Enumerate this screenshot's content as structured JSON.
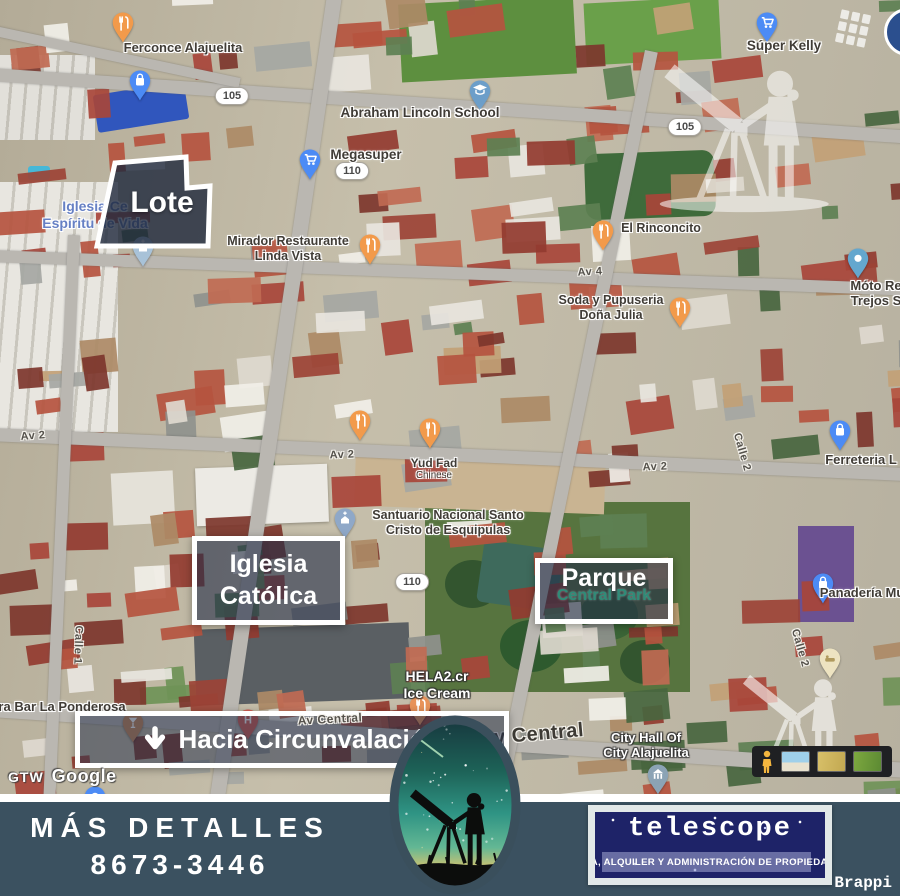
{
  "colors": {
    "footer_bg": "#3b5160",
    "overlay_navy": "#212c46",
    "brand_navy": "#1e2368",
    "pin_orange": "#F29A4B",
    "pin_blue": "#4C8BF5",
    "park_label_teal": "#2f8c78",
    "place_label_blue": "#6680c4"
  },
  "map": {
    "overlays": {
      "lote_label": "Lote",
      "iglesia_line1": "Iglesia",
      "iglesia_line2": "Católica",
      "parque_title": "Parque",
      "parque_subtitle": "Central Park",
      "banner_text": "Hacia Circunvalación"
    },
    "route_badges": [
      {
        "text": "105",
        "x": 232,
        "y": 96
      },
      {
        "text": "105",
        "x": 685,
        "y": 127
      },
      {
        "text": "110",
        "x": 352,
        "y": 171
      },
      {
        "text": "110",
        "x": 412,
        "y": 582
      }
    ],
    "street_labels": [
      {
        "text": "Av 4",
        "x": 590,
        "y": 272,
        "rot": -3,
        "size": 11
      },
      {
        "text": "Av 2",
        "x": 33,
        "y": 436,
        "rot": -4,
        "size": 11
      },
      {
        "text": "Av 2",
        "x": 342,
        "y": 455,
        "rot": -2,
        "size": 11
      },
      {
        "text": "Av 2",
        "x": 655,
        "y": 467,
        "rot": -2,
        "size": 11
      },
      {
        "text": "Av Central",
        "x": 330,
        "y": 719,
        "rot": -3,
        "size": 12,
        "z": 9
      },
      {
        "text": "Av Central",
        "x": 532,
        "y": 735,
        "rot": -5,
        "size": 20
      },
      {
        "text": "Calle 1",
        "x": 78,
        "y": 645,
        "rot": 92,
        "size": 11
      },
      {
        "text": "Calle 2",
        "x": 742,
        "y": 452,
        "rot": 74,
        "size": 11
      },
      {
        "text": "Calle 2",
        "x": 800,
        "y": 648,
        "rot": 74,
        "size": 11
      }
    ],
    "pois": [
      {
        "pin": "restaurant",
        "color": "#F29A4B",
        "px": 123,
        "py": 16
      },
      {
        "pin": "bag",
        "color": "#4C8BF5",
        "px": 140,
        "py": 74,
        "lines": [
          "Ferconce Alajuelita"
        ],
        "lx": 183,
        "ly": 40,
        "style": "dark",
        "size": 13
      },
      {
        "pin": "school",
        "color": "#6C9EC9",
        "px": 480,
        "py": 84,
        "lines": [
          "Abraham Lincoln School"
        ],
        "lx": 420,
        "ly": 105,
        "style": "dark",
        "size": 13.5
      },
      {
        "pin": "cart",
        "color": "#4C8BF5",
        "px": 310,
        "py": 153,
        "lines": [
          "Megasuper"
        ],
        "lx": 366,
        "ly": 147,
        "style": "dark",
        "size": 13.5
      },
      {
        "pin": "cart",
        "color": "#4C8BF5",
        "px": 767,
        "py": 16,
        "lines": [
          "Súper Kelly"
        ],
        "lx": 784,
        "ly": 38,
        "style": "dark",
        "size": 13.5
      },
      {
        "pin": "restaurant",
        "color": "#F29A4B",
        "px": 370,
        "py": 238,
        "lines": [
          "Mirador Restaurante",
          "Linda Vista"
        ],
        "lx": 288,
        "ly": 234,
        "style": "dark",
        "size": 12.5
      },
      {
        "pin": "restaurant",
        "color": "#F29A4B",
        "px": 603,
        "py": 224,
        "lines": [
          "El Rinconcito"
        ],
        "lx": 661,
        "ly": 221,
        "style": "dark",
        "size": 12.5
      },
      {
        "pin": "dot",
        "color": "#64A7CE",
        "px": 858,
        "py": 252,
        "lines": [
          "Móto Re",
          "Trejos S"
        ],
        "lx": 876,
        "ly": 278,
        "style": "dark",
        "size": 13
      },
      {
        "pin": "restaurant",
        "color": "#F29A4B",
        "px": 680,
        "py": 301,
        "lines": [
          "Soda y Pupuseria",
          "Doña Julia"
        ],
        "lx": 611,
        "ly": 293,
        "style": "dark",
        "size": 12.5
      },
      {
        "pin": "restaurant",
        "color": "#F29A4B",
        "px": 360,
        "py": 414
      },
      {
        "pin": "restaurant",
        "color": "#F29A4B",
        "px": 430,
        "py": 422,
        "lines": [
          "Yud Fad",
          "Chinese"
        ],
        "lx": 434,
        "ly": 456,
        "style": "dark",
        "size": 12,
        "sub": true
      },
      {
        "pin": "bag",
        "color": "#4C8BF5",
        "px": 840,
        "py": 424,
        "lines": [
          "Ferreteria L"
        ],
        "lx": 861,
        "ly": 452,
        "style": "dark",
        "size": 13
      },
      {
        "pin": "church",
        "color": "#8FA8C8",
        "px": 345,
        "py": 512,
        "lines": [
          "Santuario Nacional Santo",
          "Cristo de Esquipulas"
        ],
        "lx": 448,
        "ly": 508,
        "style": "dark",
        "size": 12.5
      },
      {
        "pin": "bag",
        "color": "#4C8BF5",
        "px": 823,
        "py": 577,
        "lines": [
          "Panadería Mu"
        ],
        "lx": 862,
        "ly": 585,
        "style": "dark",
        "size": 13
      },
      {
        "pin": "lodging",
        "color": "#EDE3C1",
        "px": 830,
        "py": 652
      },
      {
        "pin": "cocktail",
        "color": "#C98A5B",
        "px": 133,
        "py": 716
      },
      {
        "pin": "hospital",
        "color": "#D65F54",
        "px": 248,
        "py": 713
      },
      {
        "pin": "restaurant",
        "color": "#E8935A",
        "px": 420,
        "py": 699
      },
      {
        "pin": "church",
        "color": "#A8C2D8",
        "px": 143,
        "py": 240
      },
      {
        "pin": "bank",
        "color": "#8BA3B5",
        "px": 658,
        "py": 768,
        "lines": [
          "City Hall Of",
          "City Alajuelita"
        ],
        "lx": 646,
        "ly": 730,
        "style": "white",
        "size": 13
      },
      {
        "pin": "dot",
        "color": "#4C8BF5",
        "px": 95,
        "py": 790
      },
      {
        "lines": [
          "Iglesia Ce",
          "Espíritu de Vida"
        ],
        "lx": 95,
        "ly": 198,
        "style": "blue",
        "size": 14
      },
      {
        "lines": [
          "HELA2.cr",
          "Ice Cream"
        ],
        "lx": 437,
        "ly": 668,
        "style": "white",
        "size": 14
      },
      {
        "lines": [
          "Almacén"
        ],
        "lx": 852,
        "ly": 746,
        "style": "white",
        "size": 12.5
      },
      {
        "lines": [
          "ra Bar La Ponderosa"
        ],
        "lx": 62,
        "ly": 699,
        "style": "dark",
        "size": 13
      }
    ],
    "attribution": {
      "gtw": "GTW",
      "brand": "Google"
    }
  },
  "footer": {
    "details_label": "MÁS DETALLES",
    "phone": "8673-3446",
    "brand_name": "telescope",
    "brand_tagline": "VENTA, ALQUILER Y ADMINISTRACIÓN DE PROPIEDADES",
    "credit": "Brappi"
  }
}
